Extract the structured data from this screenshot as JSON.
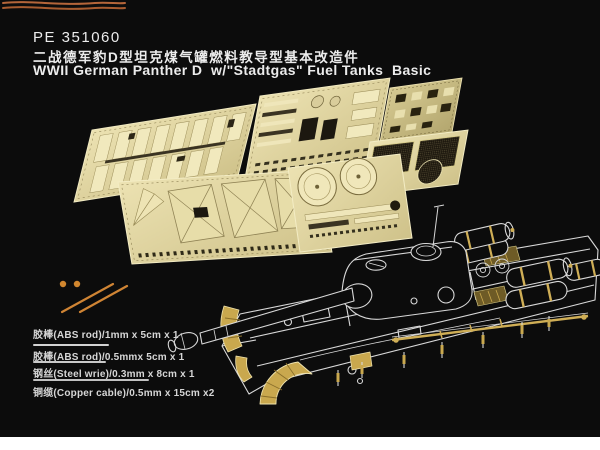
{
  "header": {
    "product_code": "PE 351060",
    "title_cn": "二战德军豹D型坦克煤气罐燃料教导型基本改造件",
    "title_en": "WWII German Panther D  w/\"Stadtgas\" Fuel Tanks  Basic"
  },
  "materials": [
    {
      "label": "胶棒(ABS rod)/1mm x 5cm x 1"
    },
    {
      "label": "胶棒(ABS rod)/0.5mmx 5cm x 1"
    },
    {
      "label": "钢丝(Steel wrie)/0.3mm x 8cm x 1"
    },
    {
      "label": "铜缆(Copper cable)/0.5mm x 15cm x2"
    }
  ],
  "colors": {
    "background": "#0c0c0c",
    "text": "#ececec",
    "brass": "#d9cd9b",
    "brass_light": "#f2eac0",
    "brass_dark": "#2c2616",
    "mesh": "#433c28",
    "gold_accent": "#cfae56",
    "copper": "#b5663a",
    "rod_orange": "#d1872f",
    "tank_line": "#d8d8d8",
    "bottom_margin": "#ffffff"
  }
}
